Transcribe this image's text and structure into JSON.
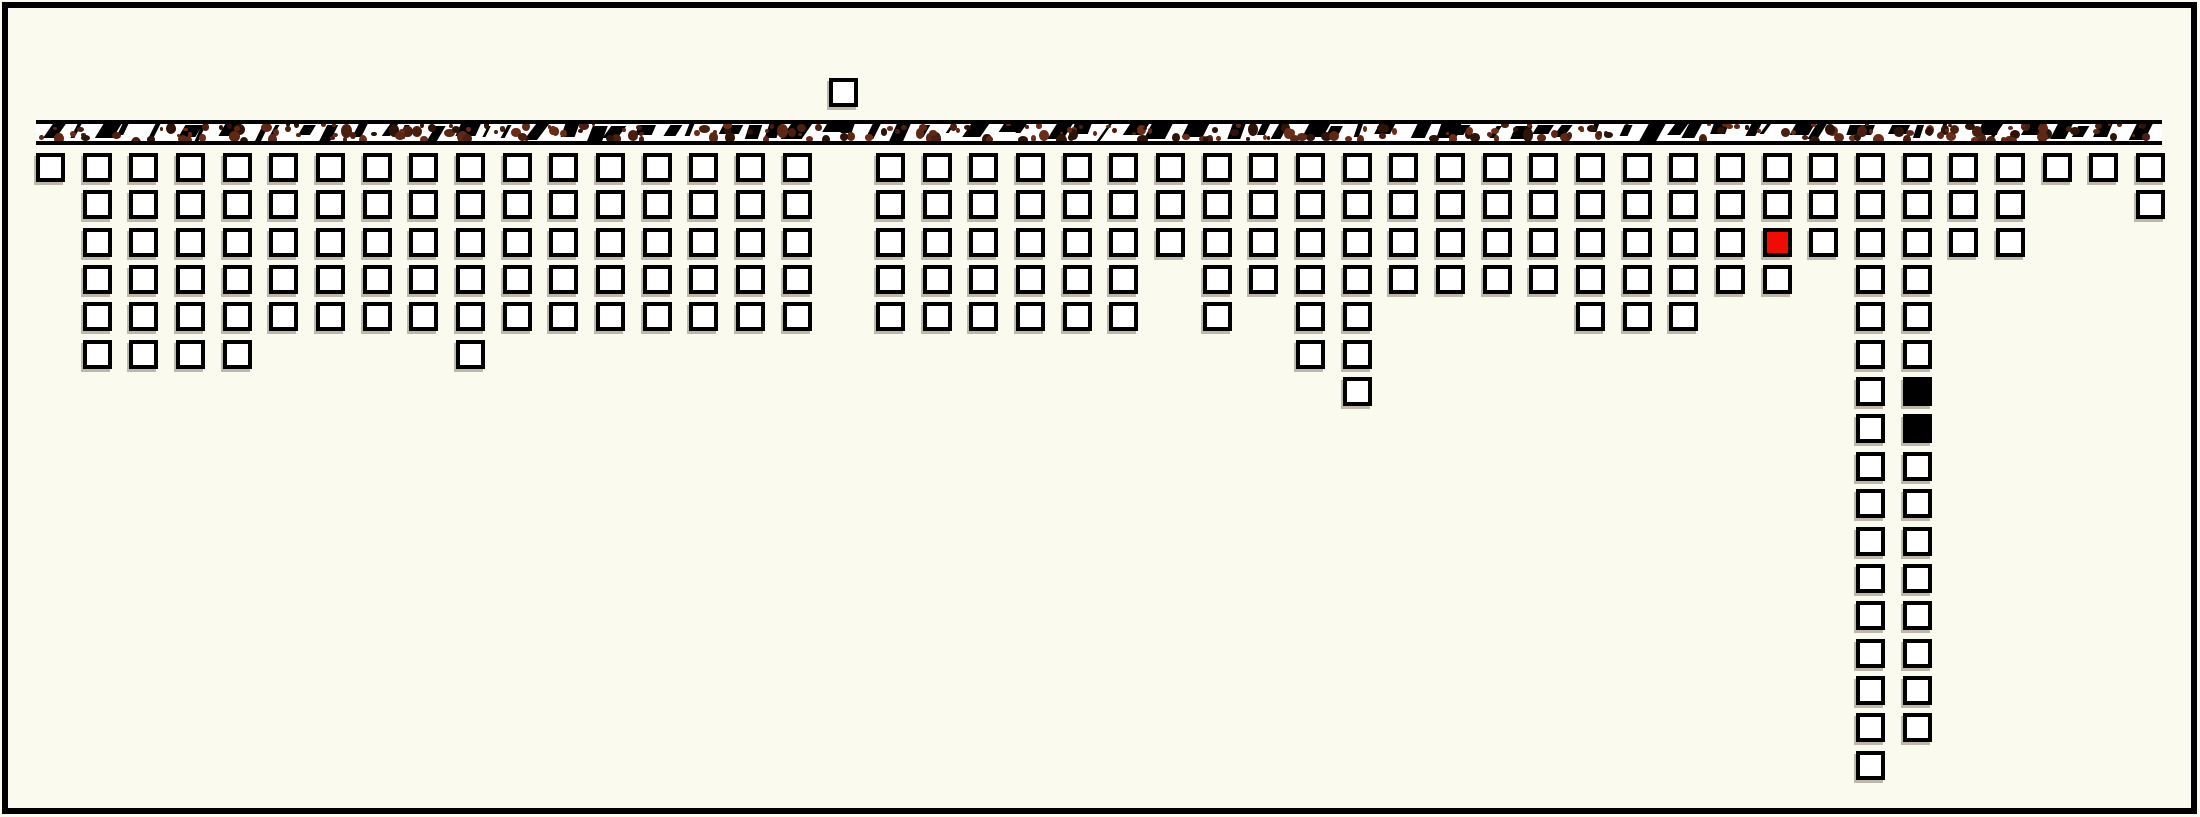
{
  "canvas": {
    "width": 2200,
    "height": 817,
    "background": "#FBFAEF"
  },
  "frame": {
    "inset": 2,
    "thickness": 6,
    "color": "#000000"
  },
  "bar": {
    "x": 36,
    "y": 120,
    "width": 2126,
    "height": 25,
    "border_color": "#000000",
    "fill": "#FFFFFF",
    "texture": {
      "slash_color": "#000000",
      "stain_colors": [
        "#2E1309",
        "#4A1F10",
        "#5F2814",
        "#6B2D18"
      ],
      "slash_count": 82,
      "stain_count": 260,
      "seed": 11
    }
  },
  "grid": {
    "origin_x": 36,
    "origin_y": 153,
    "pitch_x": 46.67,
    "pitch_y": 37.35,
    "cell_size": 29,
    "cell_border": 4,
    "cell_fill": "#FFFFFF",
    "cell_border_color": "#000000",
    "cell_shadow": "-2px 3px 0 rgba(95,88,70,0.40)",
    "column_count": 46,
    "max_depth": 17,
    "total_squares": 227,
    "column_depths": [
      1,
      6,
      6,
      6,
      6,
      5,
      5,
      5,
      5,
      6,
      5,
      5,
      5,
      5,
      5,
      5,
      5,
      0,
      5,
      5,
      5,
      5,
      5,
      5,
      3,
      5,
      4,
      6,
      7,
      4,
      4,
      4,
      4,
      5,
      5,
      5,
      4,
      4,
      3,
      17,
      16,
      3,
      3,
      1,
      1,
      2
    ],
    "special_cells": [
      {
        "col": 38,
        "row": 3,
        "fill": "#F00C00",
        "name": "red-square"
      },
      {
        "col": 41,
        "row": 7,
        "fill": "#000000",
        "name": "black-square"
      },
      {
        "col": 41,
        "row": 8,
        "fill": "#000000",
        "name": "black-square"
      }
    ],
    "floating_square": {
      "col": 18,
      "rows_above_baseline": 2
    }
  }
}
